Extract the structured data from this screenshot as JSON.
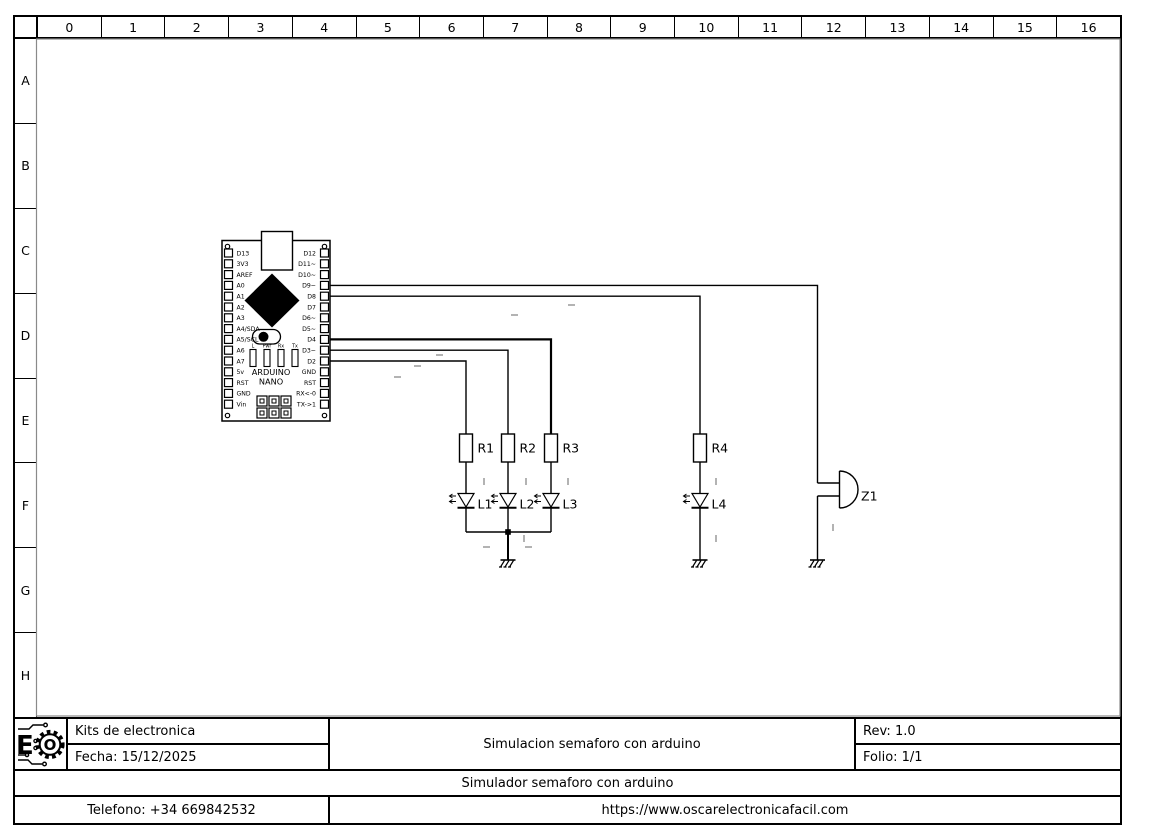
{
  "sheet": {
    "columns": [
      "0",
      "1",
      "2",
      "3",
      "4",
      "5",
      "6",
      "7",
      "8",
      "9",
      "10",
      "11",
      "12",
      "13",
      "14",
      "15",
      "16"
    ],
    "rows": [
      "A",
      "B",
      "C",
      "D",
      "E",
      "F",
      "G",
      "H"
    ]
  },
  "title_block": {
    "company": "Kits de electronica",
    "date_label": "Fecha: 15/12/2025",
    "main_title": "Simulacion semaforo con arduino",
    "revision": "Rev: 1.0",
    "folio": "Folio: 1/1",
    "subtitle": "Simulador semaforo con arduino",
    "phone": "Telefono: +34 669842532",
    "website": "https://www.oscarelectronicafacil.com",
    "logo": {
      "e": "E",
      "o": "O"
    }
  },
  "arduino": {
    "title_line1": "ARDUINO",
    "title_line2": "NANO",
    "left_pins": [
      "D13",
      "3V3",
      "AREF",
      "A0",
      "A1",
      "A2",
      "A3",
      "A4/SDA",
      "A5/SCL",
      "A6",
      "A7",
      "5v",
      "RST",
      "GND",
      "Vin"
    ],
    "right_pins": [
      "D12",
      "D11~",
      "D10~",
      "D9~",
      "D8",
      "D7",
      "D6~",
      "D5~",
      "D4",
      "D3~",
      "D2",
      "GND",
      "RST",
      "RX<-0",
      "TX->1"
    ],
    "indicators": [
      "L",
      "Pwr",
      "Rx",
      "Tx"
    ]
  },
  "components": {
    "resistor_refs": [
      "R1",
      "R2",
      "R3",
      "R4"
    ],
    "led_refs": [
      "L1",
      "L2",
      "L3",
      "L4"
    ],
    "buzzer_ref": "Z1"
  },
  "colors": {
    "line": "#000000",
    "faint": "#b3b3b3",
    "frame_shadow": "#8a8a8a",
    "background": "#ffffff"
  }
}
